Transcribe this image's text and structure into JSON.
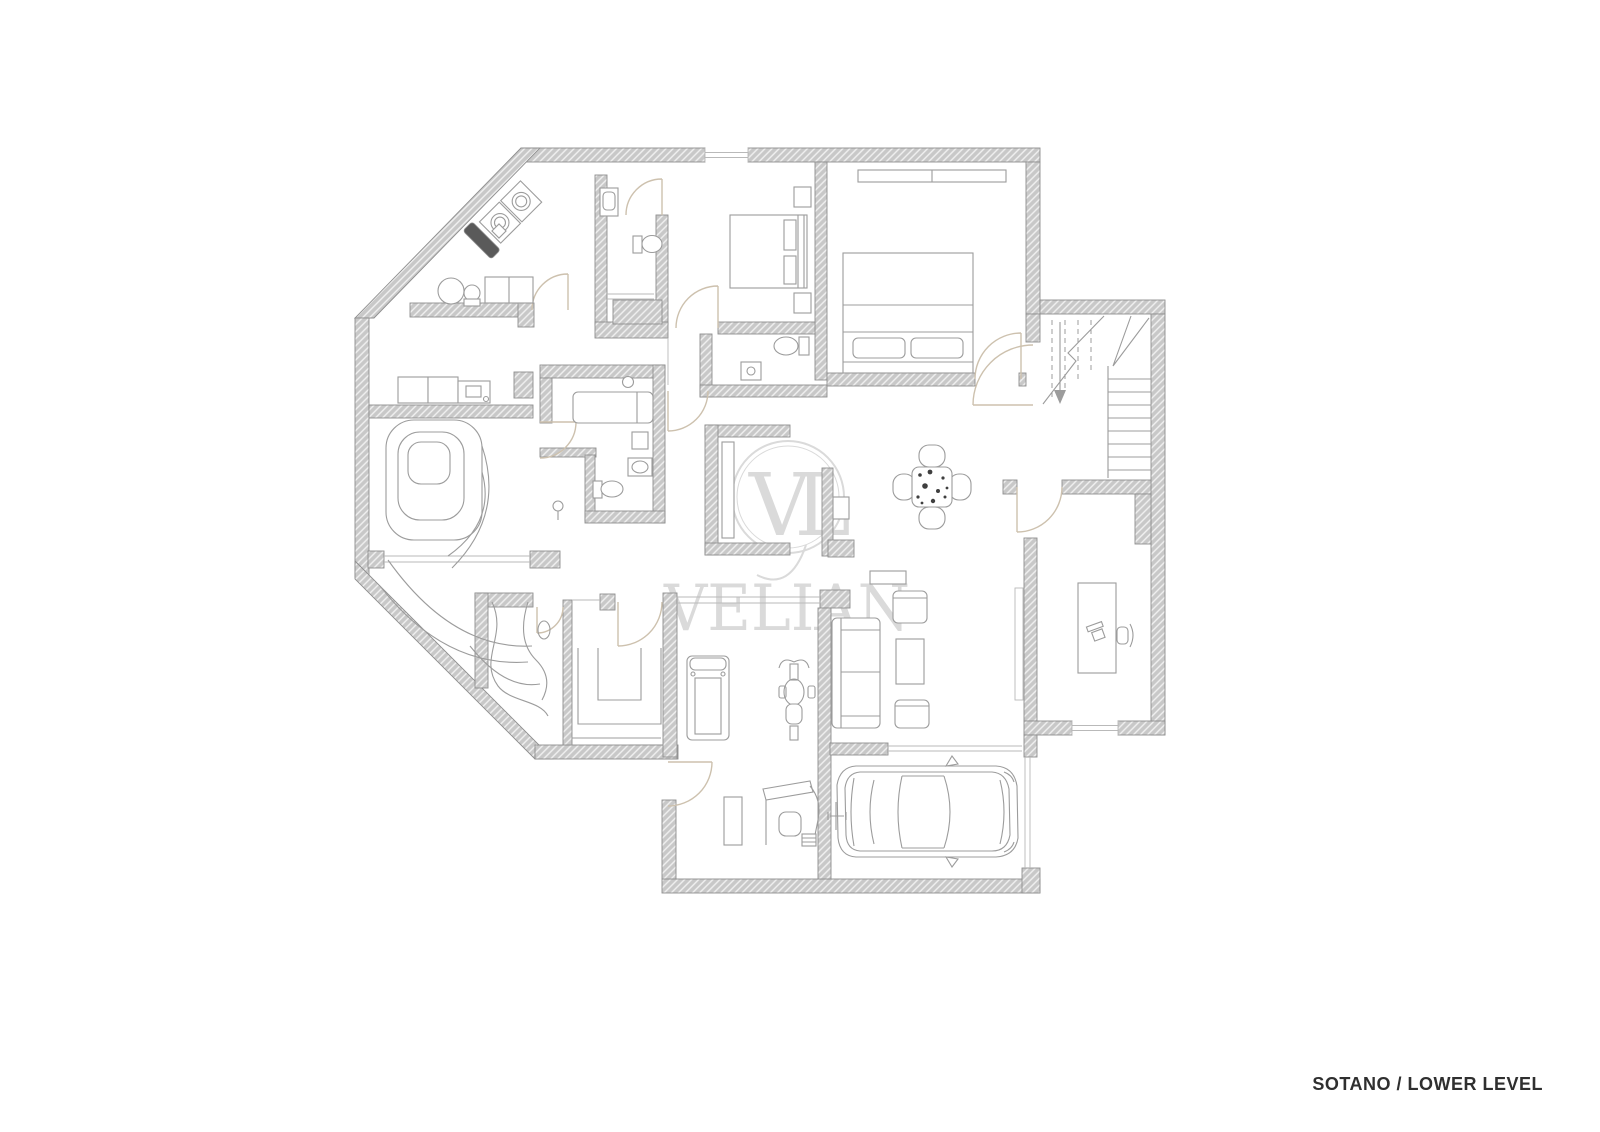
{
  "title": {
    "label": "SOTANO / LOWER LEVEL"
  },
  "watermark": {
    "brand": "VELIAN",
    "monogram": "VL"
  },
  "palette": {
    "wall_fill": "#c8c8c8",
    "wall_edge": "#8e8e8e",
    "furniture_line": "#9c9c9c",
    "floor_line": "#b9b9b9",
    "door_arc": "#cdc1ae",
    "watermark": "#dadada",
    "title_color": "#2f2f2f",
    "speckle": "#3f3f3f",
    "dark_fixture": "#5a5a5a"
  }
}
